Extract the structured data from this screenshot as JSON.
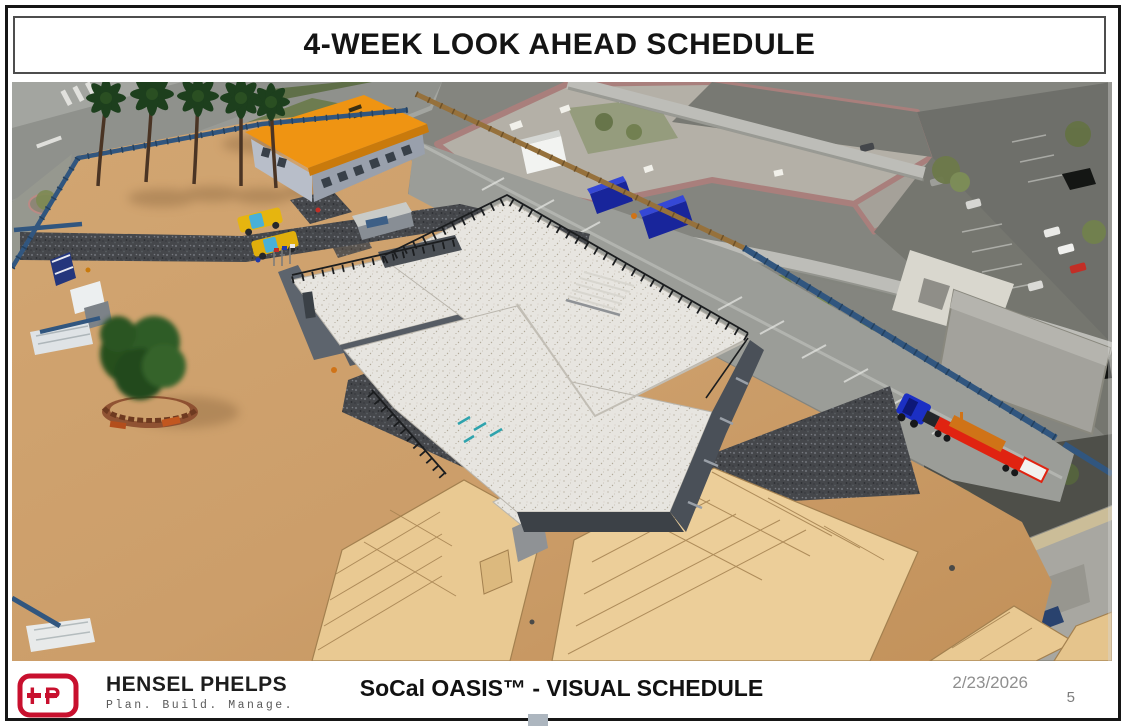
{
  "slide": {
    "title": "4-WEEK LOOK AHEAD SCHEDULE"
  },
  "footer": {
    "logo": {
      "monogram": "HP",
      "company": "HENSEL PHELPS",
      "tagline": "Plan. Build. Manage.",
      "brand_color": "#c8102e"
    },
    "subtitle": "SoCal OASIS™ - VISUAL SCHEDULE",
    "date": "2/23/2026",
    "page_number": "5"
  },
  "scene": {
    "description": "Aerial 3D construction-site visual schedule render over photogrammetry context",
    "elements": [
      "office-trailer-orange-roof",
      "yellow-pickup-trucks",
      "guard-shack",
      "palm-tree-row",
      "site-tree-with-planter",
      "porta-potties",
      "storage-containers",
      "blue-dumpsters",
      "white-trailer",
      "main-building-concrete-decks",
      "roof-guardrails",
      "roof-stairs",
      "gravel-paths",
      "plywood-formwork-decking",
      "flatbed-truck-with-load",
      "blue-perimeter-fence",
      "wood-perimeter-fence",
      "access-street",
      "shopping-center-building",
      "parking-lots",
      "sound-wall"
    ],
    "colors": {
      "dirt": "#cc9f6b",
      "gravel": "#46484c",
      "concrete_deck": "#e7e5e0",
      "building_wall": "#5a6068",
      "trailer_roof_orange": "#f09312",
      "fence_blue": "#355d8c",
      "fence_wood": "#8f6a3c",
      "dumpster_blue": "#18259b",
      "pickup_yellow": "#e6b50f",
      "lowboy_trailer_red": "#e02311",
      "equipment_load_orange": "#d07317",
      "street": "#9b9d98",
      "mall_roof": "#b5b1a8",
      "mall_parapet_pink": "#a97f7c",
      "plywood": "#e9c992"
    }
  }
}
